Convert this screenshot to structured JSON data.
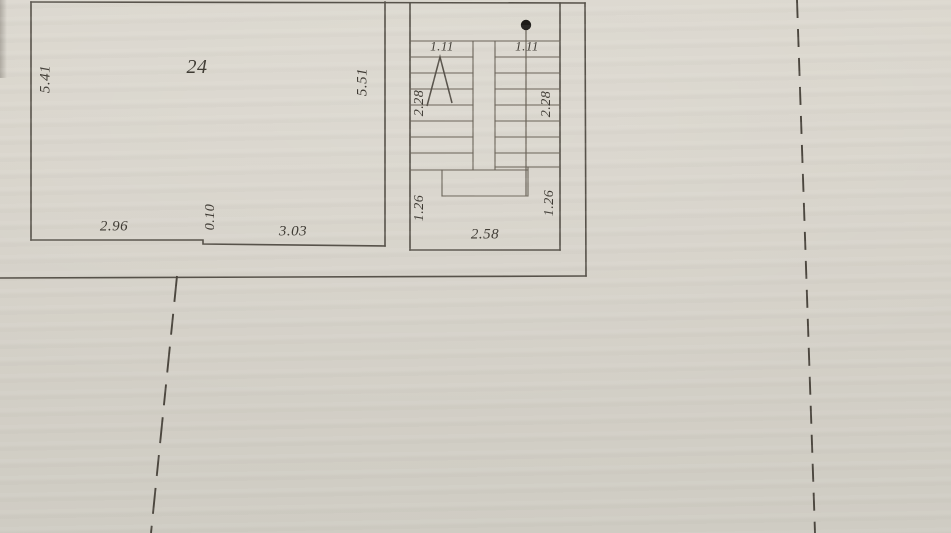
{
  "document": {
    "kind": "scanned floor plan fragment",
    "room_number": "24"
  },
  "colors": {
    "paper_light": "#dbd7ce",
    "paper": "#d6d2c9",
    "paper_dark": "#cfccc3",
    "wall_line": "#57524a",
    "stair_line": "#6b6459",
    "ink": "#3e3a33",
    "dot": "#1d1b18",
    "dashed": "#4b463e"
  },
  "plan": {
    "room": {
      "number": "24",
      "left_height": "5.41",
      "right_height": "5.51",
      "bottom_width_left": "2.96",
      "bottom_wall_offset": "0.10",
      "bottom_width_right": "3.03"
    },
    "stairwell": {
      "flight_width_left": "1.11",
      "flight_width_right": "1.11",
      "flight_run_left": "2.28",
      "flight_run_right": "2.28",
      "landing_depth_left": "1.26",
      "landing_depth_right": "1.26",
      "overall_width": "2.58"
    }
  },
  "labels": [
    {
      "name": "room-number-label",
      "text": "24",
      "x": 197,
      "y": 67,
      "rot": 0,
      "size": 20
    },
    {
      "name": "room-left-height-label",
      "text": "5.41",
      "x": 46,
      "y": 79,
      "rot": -90,
      "size": 15
    },
    {
      "name": "room-right-height-label",
      "text": "5.51",
      "x": 363,
      "y": 82,
      "rot": -90,
      "size": 15
    },
    {
      "name": "room-bottom-width-left-label",
      "text": "2.96",
      "x": 114,
      "y": 227,
      "rot": 0,
      "size": 15
    },
    {
      "name": "wall-offset-label",
      "text": "0.10",
      "x": 211,
      "y": 217,
      "rot": -90,
      "size": 14
    },
    {
      "name": "room-bottom-width-right-label",
      "text": "3.03",
      "x": 293,
      "y": 232,
      "rot": 0,
      "size": 15
    },
    {
      "name": "flight-width-left-label",
      "text": "1.11",
      "x": 442,
      "y": 46,
      "rot": 0,
      "size": 13
    },
    {
      "name": "flight-width-right-label",
      "text": "1.11",
      "x": 527,
      "y": 46,
      "rot": 0,
      "size": 13
    },
    {
      "name": "flight-run-left-label",
      "text": "2.28",
      "x": 420,
      "y": 103,
      "rot": -90,
      "size": 14
    },
    {
      "name": "flight-run-right-label",
      "text": "2.28",
      "x": 547,
      "y": 104,
      "rot": -90,
      "size": 14
    },
    {
      "name": "landing-depth-left-label",
      "text": "1.26",
      "x": 420,
      "y": 208,
      "rot": -90,
      "size": 14
    },
    {
      "name": "landing-depth-right-label",
      "text": "1.26",
      "x": 550,
      "y": 203,
      "rot": -90,
      "size": 14
    },
    {
      "name": "stairwell-width-label",
      "text": "2.58",
      "x": 485,
      "y": 235,
      "rot": 0,
      "size": 15
    }
  ]
}
